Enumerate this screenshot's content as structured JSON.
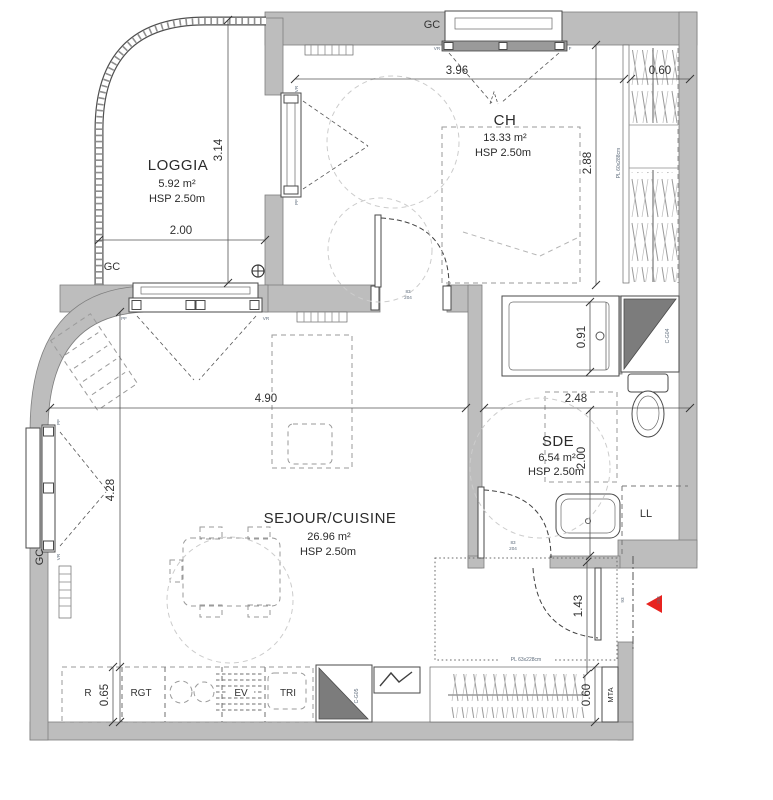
{
  "rooms": {
    "loggia": {
      "name": "LOGGIA",
      "area": "5.92 m²",
      "hsp": "HSP 2.50m"
    },
    "ch": {
      "name": "CH",
      "area": "13.33 m²",
      "hsp": "HSP 2.50m"
    },
    "sejour": {
      "name": "SEJOUR/CUISINE",
      "area": "26.96 m²",
      "hsp": "HSP 2.50m"
    },
    "sde": {
      "name": "SDE",
      "area": "6.54 m²",
      "hsp": "HSP 2.50m"
    }
  },
  "dims": {
    "ch_width": "3.96",
    "closet_depth": "0.60",
    "ch_height": "2.88",
    "loggia_height": "3.14",
    "loggia_width": "2.00",
    "sejour_width": "4.90",
    "sejour_height": "4.28",
    "sde_width": "2.48",
    "sde_height": "2.00",
    "shower_width": "0.91",
    "entry_length": "1.43",
    "kitchen_depth": "0.65",
    "wardrobe_depth": "0.60"
  },
  "doors": {
    "ch": {
      "w": "83",
      "h": "204"
    },
    "sde": {
      "w": "83",
      "h": "204"
    },
    "entry": {
      "w": "93",
      "h": "204"
    }
  },
  "fixtures": {
    "fridge": "R",
    "storage": "RGT",
    "sink": "EV",
    "waste": "TRI",
    "washer": "LL",
    "meter": "MTA",
    "duct_bath": "C-G04",
    "duct_kitchen": "C-G05",
    "closet_ch": "PL 60x288cm",
    "closet_entry": "PL 63x228cm"
  },
  "wall_labels": {
    "gc": "GC"
  },
  "window_labels": {
    "vr": "VR",
    "pf": "PF",
    "f": "F"
  },
  "colors": {
    "wall": "#bdbdbd",
    "duct": "#7c7c7c",
    "entry_arrow": "#e8231f",
    "small_label": "#5d6b7b"
  }
}
